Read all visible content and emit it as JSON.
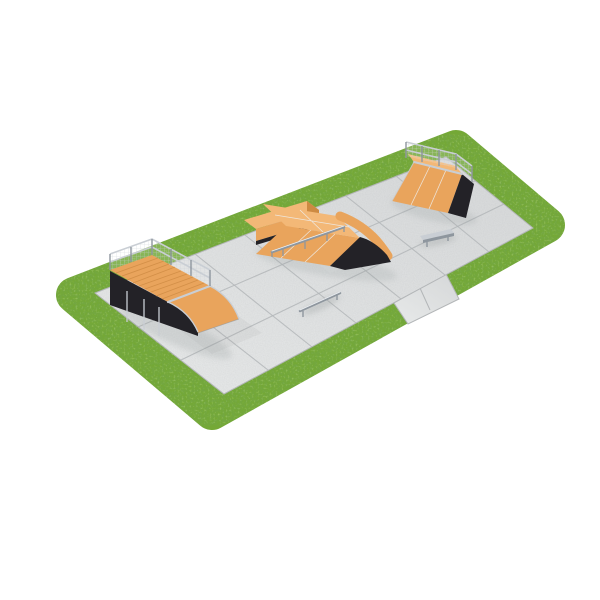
{
  "scene": {
    "type": "3d-product-render",
    "subject": "modular skatepark set on a concrete slab pad surrounded by a grass lawn border",
    "background": "#ffffff",
    "view": "elevated isometric-style view, park long axis running lower-left to upper-right"
  },
  "colors": {
    "background": "#ffffff",
    "grass_base": "#74a836",
    "grass_dark": "#3f6b1a",
    "grass_light": "#a8d05c",
    "concrete": "#d7d9da",
    "concrete_light": "#e7e9e9",
    "concrete_joint": "#b3b6b8",
    "plywood": "#e9a45c",
    "plywood_light": "#f3b877",
    "plywood_dark": "#cd8a42",
    "frame_black": "#232227",
    "steel": "#c9ced4",
    "steel_dark": "#8e969e",
    "steel_light": "#eef1f4",
    "shadow": "#8f9496"
  },
  "objects": {
    "lawn": "grass lawn border with rounded corners",
    "concrete_pad": "concrete slab pad, 3 x 7 square slabs",
    "entry_path": "concrete entry path crossing the lawn at bottom-right",
    "quarter_pipe": "quarter pipe with slatted deck platform and mesh guard rail (left)",
    "funbox": "funbox with bank, flat top, curved roll-over and grind rail (center)",
    "ledge": "wooden grind ledge behind funbox (center-left)",
    "bank_ramp": "bank ramp with top platform and mesh safety fence (upper right)",
    "flat_rail": "low flat-bar grind rail (right)",
    "round_rail": "round-tube grind rail (center front)"
  }
}
